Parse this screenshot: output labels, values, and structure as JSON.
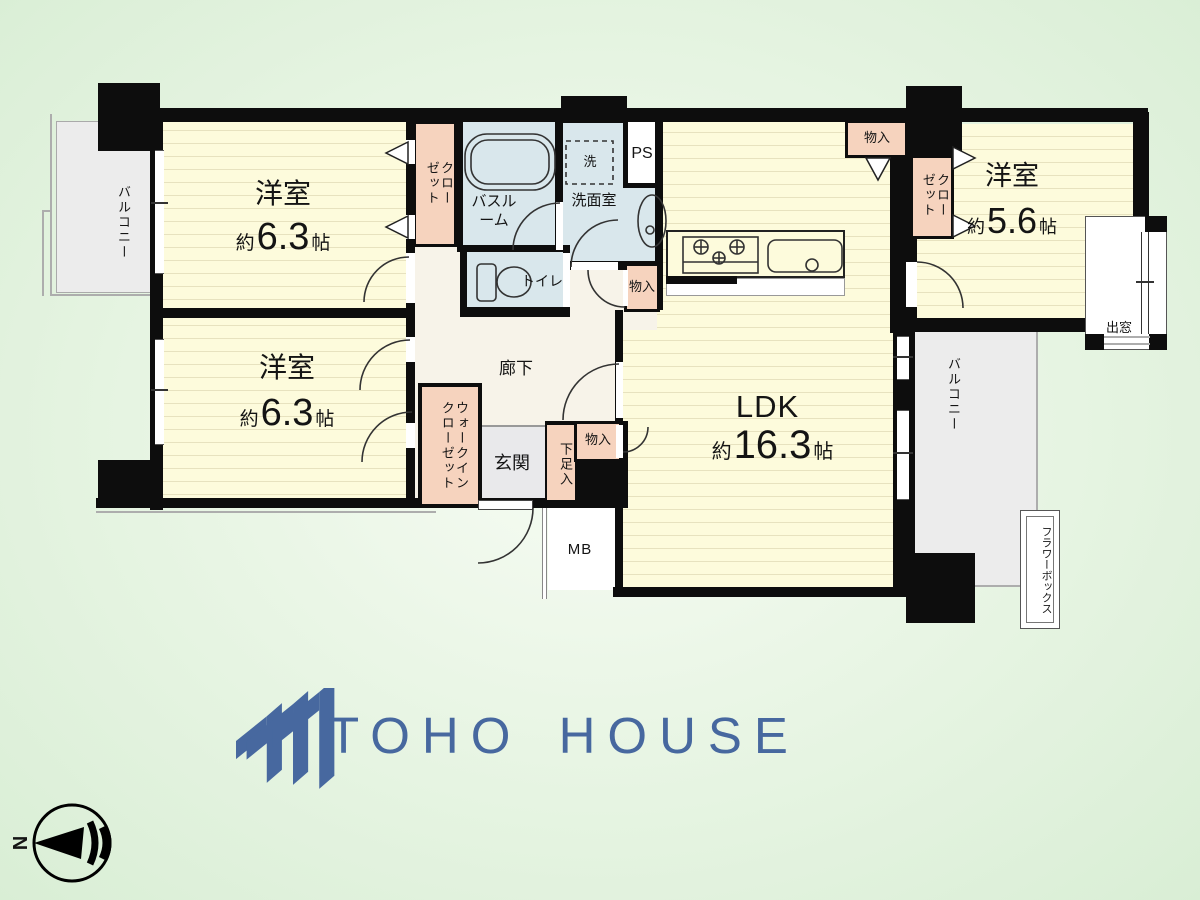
{
  "brand": {
    "name": "TOHO HOUSE",
    "color": "#47689f"
  },
  "compass": {
    "north": "N"
  },
  "colors": {
    "background_green": "#e4f3e0",
    "room_floor": "#fdfbdc",
    "hall_floor": "#f7f3e9",
    "wet_area": "#d9e7ec",
    "closet_pink": "#f6d3be",
    "balcony_gray": "#ececec",
    "wall": "#0d0d0d",
    "logo_blue": "#47689f"
  },
  "labels": {
    "bedroom1": {
      "name": "洋室",
      "size_about": "約",
      "size_value": "6.3",
      "size_unit": "帖"
    },
    "bedroom2": {
      "name": "洋室",
      "size_about": "約",
      "size_value": "6.3",
      "size_unit": "帖"
    },
    "bedroom3": {
      "name": "洋室",
      "size_about": "約",
      "size_value": "5.6",
      "size_unit": "帖"
    },
    "ldk": {
      "name": "LDK",
      "size_about": "約",
      "size_value": "16.3",
      "size_unit": "帖"
    },
    "hallway": "廊下",
    "entrance": "玄関",
    "shoe_cabinet": "下足入",
    "wic": "ウォークインクローゼット",
    "closet_left": "クローゼット",
    "closet_right": "クローゼット",
    "storage_top": "物入",
    "storage_hall": "物入",
    "storage_wash": "物入",
    "toilet": "トイレ",
    "bathroom": "バスルーム",
    "washroom": "洗面室",
    "washer": "洗",
    "ps": "PS",
    "mb": "MB",
    "balcony_left": "バルコニー",
    "balcony_right": "バルコニー",
    "bay_window": "出窓",
    "flower_box": "フラワーボックス"
  }
}
